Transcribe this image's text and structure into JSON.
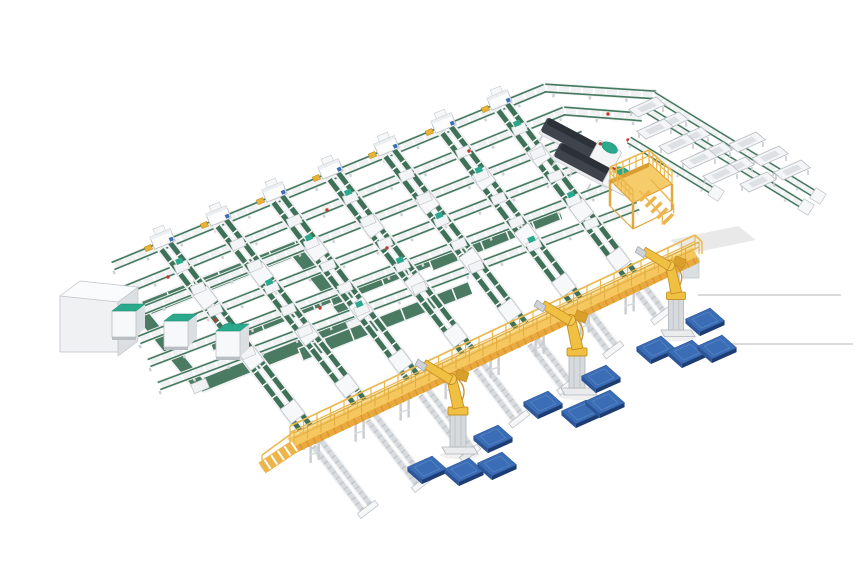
{
  "scene": {
    "kind": "isometric-3d-render",
    "subject": "automated-parcel-sorting-and-palletizing-facility"
  },
  "colors": {
    "belt_green": "#3f7158",
    "belt_green_wide": "#4a7a62",
    "rail_green": "#45795f",
    "teal": "#2aa98d",
    "frame_white": "#f1f2f4",
    "frame_stroke": "#bcc1c6",
    "gray_light": "#d8dbde",
    "gray_mid": "#c2c7cb",
    "gray_leg": "#ced2d6",
    "walkway_deck": "#f6c75f",
    "walkway_skirt": "#e9a93f",
    "walkway_rail": "#eab84e",
    "walkway_edge": "#fbe09a",
    "ramp": "#edb44a",
    "mezz_top": "#f6cb69",
    "mezz_edge": "#d99d33",
    "mezz_leg": "#e0a93e",
    "robot_yellow": "#f0c043",
    "robot_dark": "#c79023",
    "robot_mid": "#d8a02a",
    "pedestal": "#d7dadd",
    "pedestal_stroke": "#aeb4ba",
    "pallet_top": "#3a6db6",
    "pallet_side_l": "#2d5698",
    "pallet_side_r": "#1d3c72",
    "pallet_hi": "#6b93cc",
    "machine_top": "#2c3137",
    "machine_body": "#3f444c",
    "red_dot": "#c0392b",
    "blue_tag": "#3a6db6",
    "yellow_tag": "#e6b23a",
    "floor_line": "#dadada",
    "shadow": "#e9e9e9"
  },
  "layout": {
    "canvas": [
      860,
      580
    ],
    "axes": {
      "u": [
        0.915,
        -0.405
      ],
      "a": [
        0.6,
        0.79
      ]
    },
    "u_lines": [
      [
        [
          113,
          266
        ],
        [
          545,
          88
        ],
        [
          656,
          95
        ]
      ],
      [
        [
          120,
          292
        ],
        [
          564,
          111
        ],
        [
          642,
          117
        ]
      ],
      [
        [
          129,
          316
        ],
        [
          583,
          135
        ]
      ],
      [
        [
          139,
          340
        ],
        [
          602,
          158
        ]
      ],
      [
        [
          149,
          363
        ],
        [
          621,
          182
        ]
      ],
      [
        [
          159,
          386
        ],
        [
          638,
          206
        ]
      ]
    ],
    "spurs": [
      {
        "head": [
          165,
          245
        ],
        "foot": [
          310,
          434
        ],
        "stub": 95
      },
      {
        "head": [
          221,
          222
        ],
        "foot": [
          364,
          408
        ],
        "stub": 95
      },
      {
        "head": [
          277,
          198
        ],
        "foot": [
          417,
          383
        ],
        "stub": 88
      },
      {
        "head": [
          333,
          175
        ],
        "foot": [
          472,
          357
        ],
        "stub": 78
      },
      {
        "head": [
          389,
          152
        ],
        "foot": [
          526,
          332
        ],
        "stub": 68
      },
      {
        "head": [
          446,
          129
        ],
        "foot": [
          580,
          306
        ],
        "stub": 55
      },
      {
        "head": [
          502,
          106
        ],
        "foot": [
          634,
          280
        ],
        "stub": 45
      }
    ],
    "wide_belts": [
      [
        143,
        308,
        310,
        242
      ],
      [
        210,
        345,
        400,
        268
      ],
      [
        330,
        300,
        500,
        232
      ],
      [
        300,
        355,
        470,
        288
      ],
      [
        430,
        265,
        560,
        213
      ]
    ],
    "loop": {
      "pts": [
        [
          140,
          312
        ],
        [
          295,
          250
        ],
        [
          355,
          324
        ],
        [
          200,
          386
        ]
      ],
      "width": 12
    },
    "white_box": {
      "front": [
        60,
        296,
        58,
        56
      ],
      "top": [
        [
          60,
          296
        ],
        [
          80,
          281
        ],
        [
          138,
          287
        ],
        [
          118,
          302
        ]
      ],
      "side": [
        [
          118,
          302
        ],
        [
          138,
          287
        ],
        [
          138,
          341
        ],
        [
          118,
          356
        ]
      ]
    },
    "cabinets": [
      [
        112,
        311
      ],
      [
        164,
        321
      ],
      [
        216,
        331
      ]
    ],
    "machines": [
      {
        "x": 544,
        "y": 124,
        "angle": 28
      },
      {
        "x": 557,
        "y": 149,
        "angle": 28
      }
    ],
    "branch_tracks": [
      [
        [
          653,
          95
        ],
        [
          818,
          196
        ]
      ],
      [
        [
          641,
          106
        ],
        [
          806,
          207
        ]
      ],
      [
        [
          629,
          140
        ],
        [
          716,
          193
        ]
      ]
    ],
    "tubs": [
      [
        647,
        107
      ],
      [
        670,
        122
      ],
      [
        692,
        137
      ],
      [
        714,
        152
      ],
      [
        736,
        167
      ],
      [
        758,
        182
      ],
      [
        655,
        129
      ],
      [
        677,
        144
      ],
      [
        699,
        159
      ],
      [
        721,
        174
      ],
      [
        747,
        142
      ],
      [
        770,
        156
      ],
      [
        792,
        170
      ]
    ],
    "mezzanine": {
      "top": [
        [
          610,
          180
        ],
        [
          649,
          163
        ],
        [
          672,
          184
        ],
        [
          633,
          203
        ]
      ],
      "rail_h": 13,
      "leg_drop": 26,
      "stairs": {
        "from": [
          645,
          196
        ],
        "to": [
          668,
          219
        ],
        "steps": 5
      }
    },
    "walkway": {
      "x1": 290,
      "y1": 443,
      "x2": 695,
      "y2": 252,
      "legs": 9,
      "posts": 30,
      "ramp": {
        "from": [
          295,
          446
        ],
        "to": [
          262,
          468
        ]
      },
      "end_support": [
        683,
        258,
        16,
        20
      ]
    },
    "robots": [
      [
        458,
        447
      ],
      [
        577,
        388
      ],
      [
        676,
        330
      ]
    ],
    "pallets": [
      [
        493,
        437
      ],
      [
        427,
        468
      ],
      [
        464,
        470
      ],
      [
        497,
        464
      ],
      [
        543,
        403
      ],
      [
        581,
        412
      ],
      [
        605,
        402
      ],
      [
        601,
        377
      ],
      [
        705,
        320
      ],
      [
        656,
        348
      ],
      [
        687,
        352
      ],
      [
        717,
        347
      ]
    ],
    "red_dots": [
      [
        168,
        277
      ],
      [
        327,
        210
      ],
      [
        469,
        151
      ],
      [
        215,
        320
      ],
      [
        387,
        248
      ],
      [
        320,
        308
      ],
      [
        135,
        303
      ],
      [
        608,
        114
      ],
      [
        628,
        140
      ]
    ],
    "floor_lines": [
      [
        698,
        295,
        841,
        295
      ],
      [
        726,
        344,
        853,
        344
      ]
    ],
    "floor_blob": [
      [
        670,
        240
      ],
      [
        738,
        226
      ],
      [
        756,
        240
      ],
      [
        688,
        254
      ]
    ]
  }
}
